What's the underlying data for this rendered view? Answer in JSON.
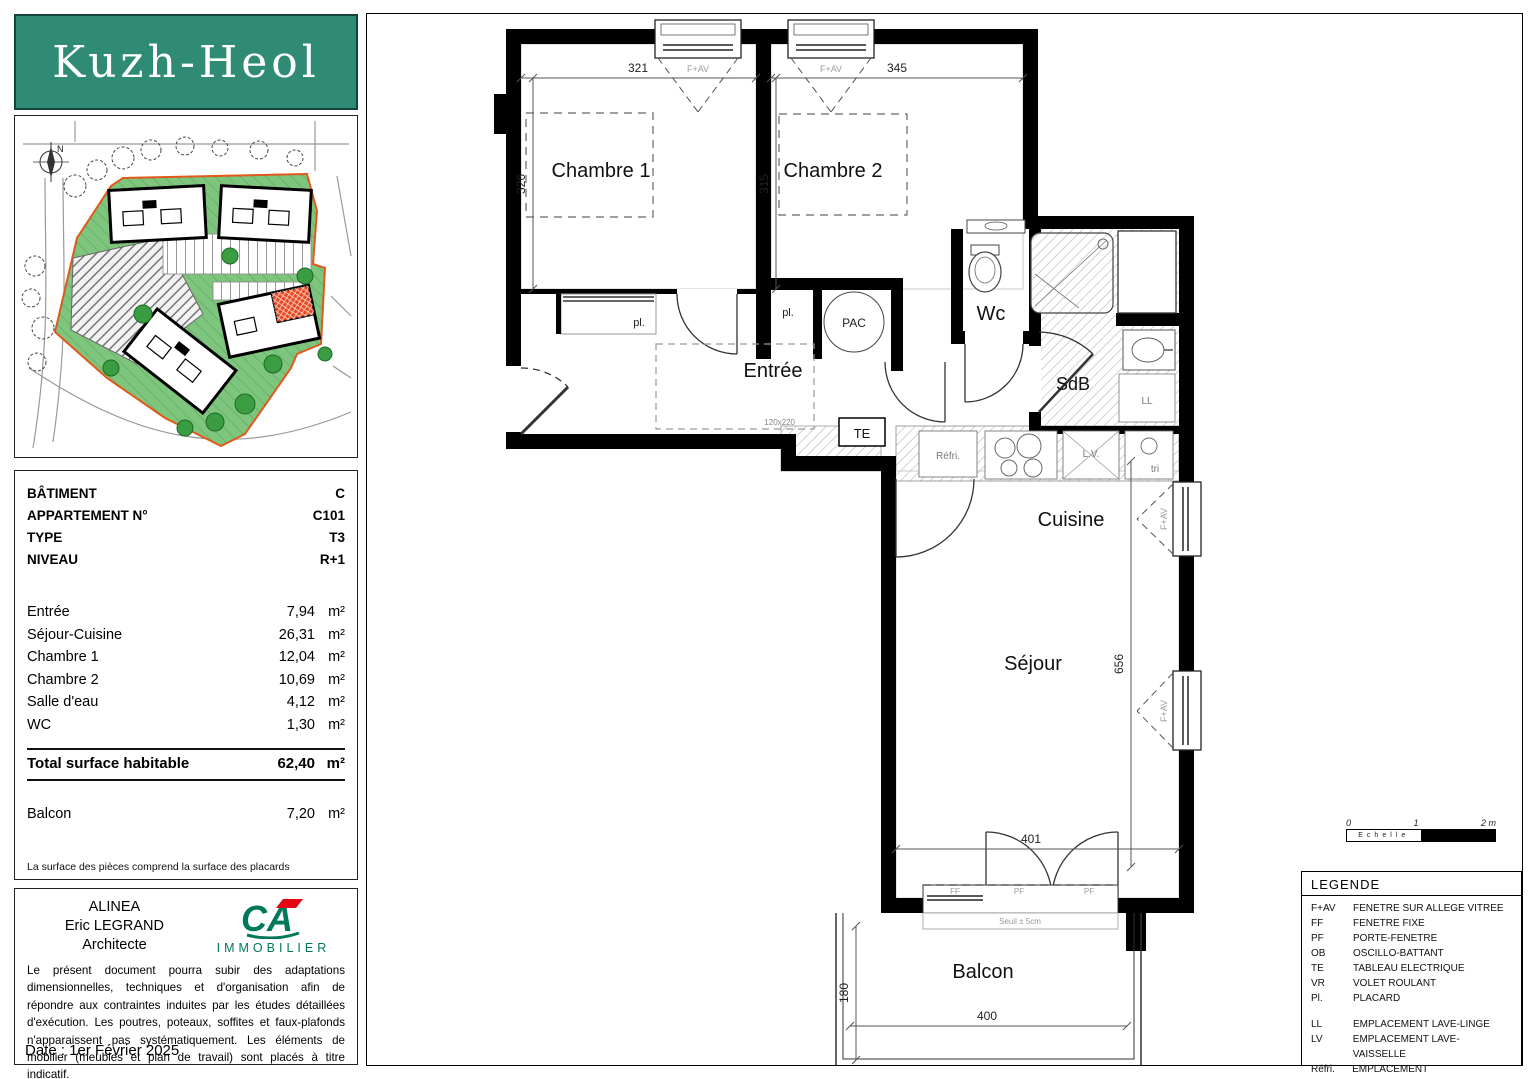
{
  "logo": {
    "title": "Kuzh-Heol"
  },
  "site_plan": {
    "north_label": "N"
  },
  "info_panel": {
    "fields": [
      {
        "label": "BÂTIMENT",
        "value": "C"
      },
      {
        "label": "APPARTEMENT N°",
        "value": "C101"
      },
      {
        "label": "TYPE",
        "value": "T3"
      },
      {
        "label": "NIVEAU",
        "value": "R+1"
      }
    ],
    "areas": [
      {
        "label": "Entrée",
        "value": "7,94",
        "unit": "m²"
      },
      {
        "label": "Séjour-Cuisine",
        "value": "26,31",
        "unit": "m²"
      },
      {
        "label": "Chambre 1",
        "value": "12,04",
        "unit": "m²"
      },
      {
        "label": "Chambre 2",
        "value": "10,69",
        "unit": "m²"
      },
      {
        "label": "Salle d'eau",
        "value": "4,12",
        "unit": "m²"
      },
      {
        "label": "WC",
        "value": "1,30",
        "unit": "m²"
      }
    ],
    "total": {
      "label": "Total surface habitable",
      "value": "62,40",
      "unit": "m²"
    },
    "balcony": {
      "label": "Balcon",
      "value": "7,20",
      "unit": "m²"
    },
    "note": "La surface des pièces comprend la surface des placards"
  },
  "architect_panel": {
    "firm": "ALINEA",
    "name": "Eric LEGRAND",
    "role": "Architecte",
    "logo_text": "CA",
    "logo_sub": "IMMOBILIER",
    "disclaimer": "Le présent document pourra subir des adaptations dimensionnelles, techniques et d'organisation afin de répondre aux contraintes induites par les études détaillées d'exécution. Les poutres, poteaux, soffites et faux-plafonds n'apparaissent pas systématiquement. Les éléments de mobilier (meubles et plan de travail) sont placés à titre indicatif.",
    "date": "Date : 1er Février 2025"
  },
  "floor_plan": {
    "rooms": {
      "chambre1": "Chambre 1",
      "chambre2": "Chambre 2",
      "entree": "Entrée",
      "wc": "Wc",
      "sdb": "SdB",
      "cuisine": "Cuisine",
      "sejour": "Séjour",
      "balcon": "Balcon"
    },
    "dims": {
      "ch1_w": "321",
      "ch1_h": "326",
      "ch2_w": "345",
      "ch2_h": "315",
      "sejour_h": "656",
      "sejour_w": "401",
      "balcon_h": "180",
      "balcon_w": "400"
    },
    "labels": {
      "window": "F+AV",
      "placard": "pl.",
      "pac": "PAC",
      "te": "TE",
      "door_size": "120x220",
      "fridge": "Réfri.",
      "dishwasher": "L.V.",
      "bin": "tri",
      "washer": "LL",
      "fixed_window": "FF",
      "door_window": "PF",
      "seuil": "Seuil ± 5cm"
    }
  },
  "scale_bar": {
    "t0": "0",
    "t1": "1",
    "t2": "2 m",
    "label": "Echelle"
  },
  "legend": {
    "title": "LEGENDE",
    "items": [
      {
        "abbr": "F+AV",
        "label": "FENETRE SUR ALLEGE VITREE"
      },
      {
        "abbr": "FF",
        "label": "FENETRE FIXE"
      },
      {
        "abbr": "PF",
        "label": "PORTE-FENETRE"
      },
      {
        "abbr": "OB",
        "label": "OSCILLO-BATTANT"
      },
      {
        "abbr": "TE",
        "label": "TABLEAU ELECTRIQUE"
      },
      {
        "abbr": "VR",
        "label": "VOLET ROULANT"
      },
      {
        "abbr": "Pl.",
        "label": "PLACARD"
      }
    ],
    "items_equipment": [
      {
        "abbr": "LL",
        "label": "EMPLACEMENT LAVE-LINGE"
      },
      {
        "abbr": "LV",
        "label": "EMPLACEMENT LAVE-VAISSELLE"
      },
      {
        "abbr": "Réfri.",
        "label": "EMPLACEMENT REFRIGERATEUR"
      }
    ],
    "hatch_label": "FAUX-PLAFOND OU SOFFITE"
  }
}
